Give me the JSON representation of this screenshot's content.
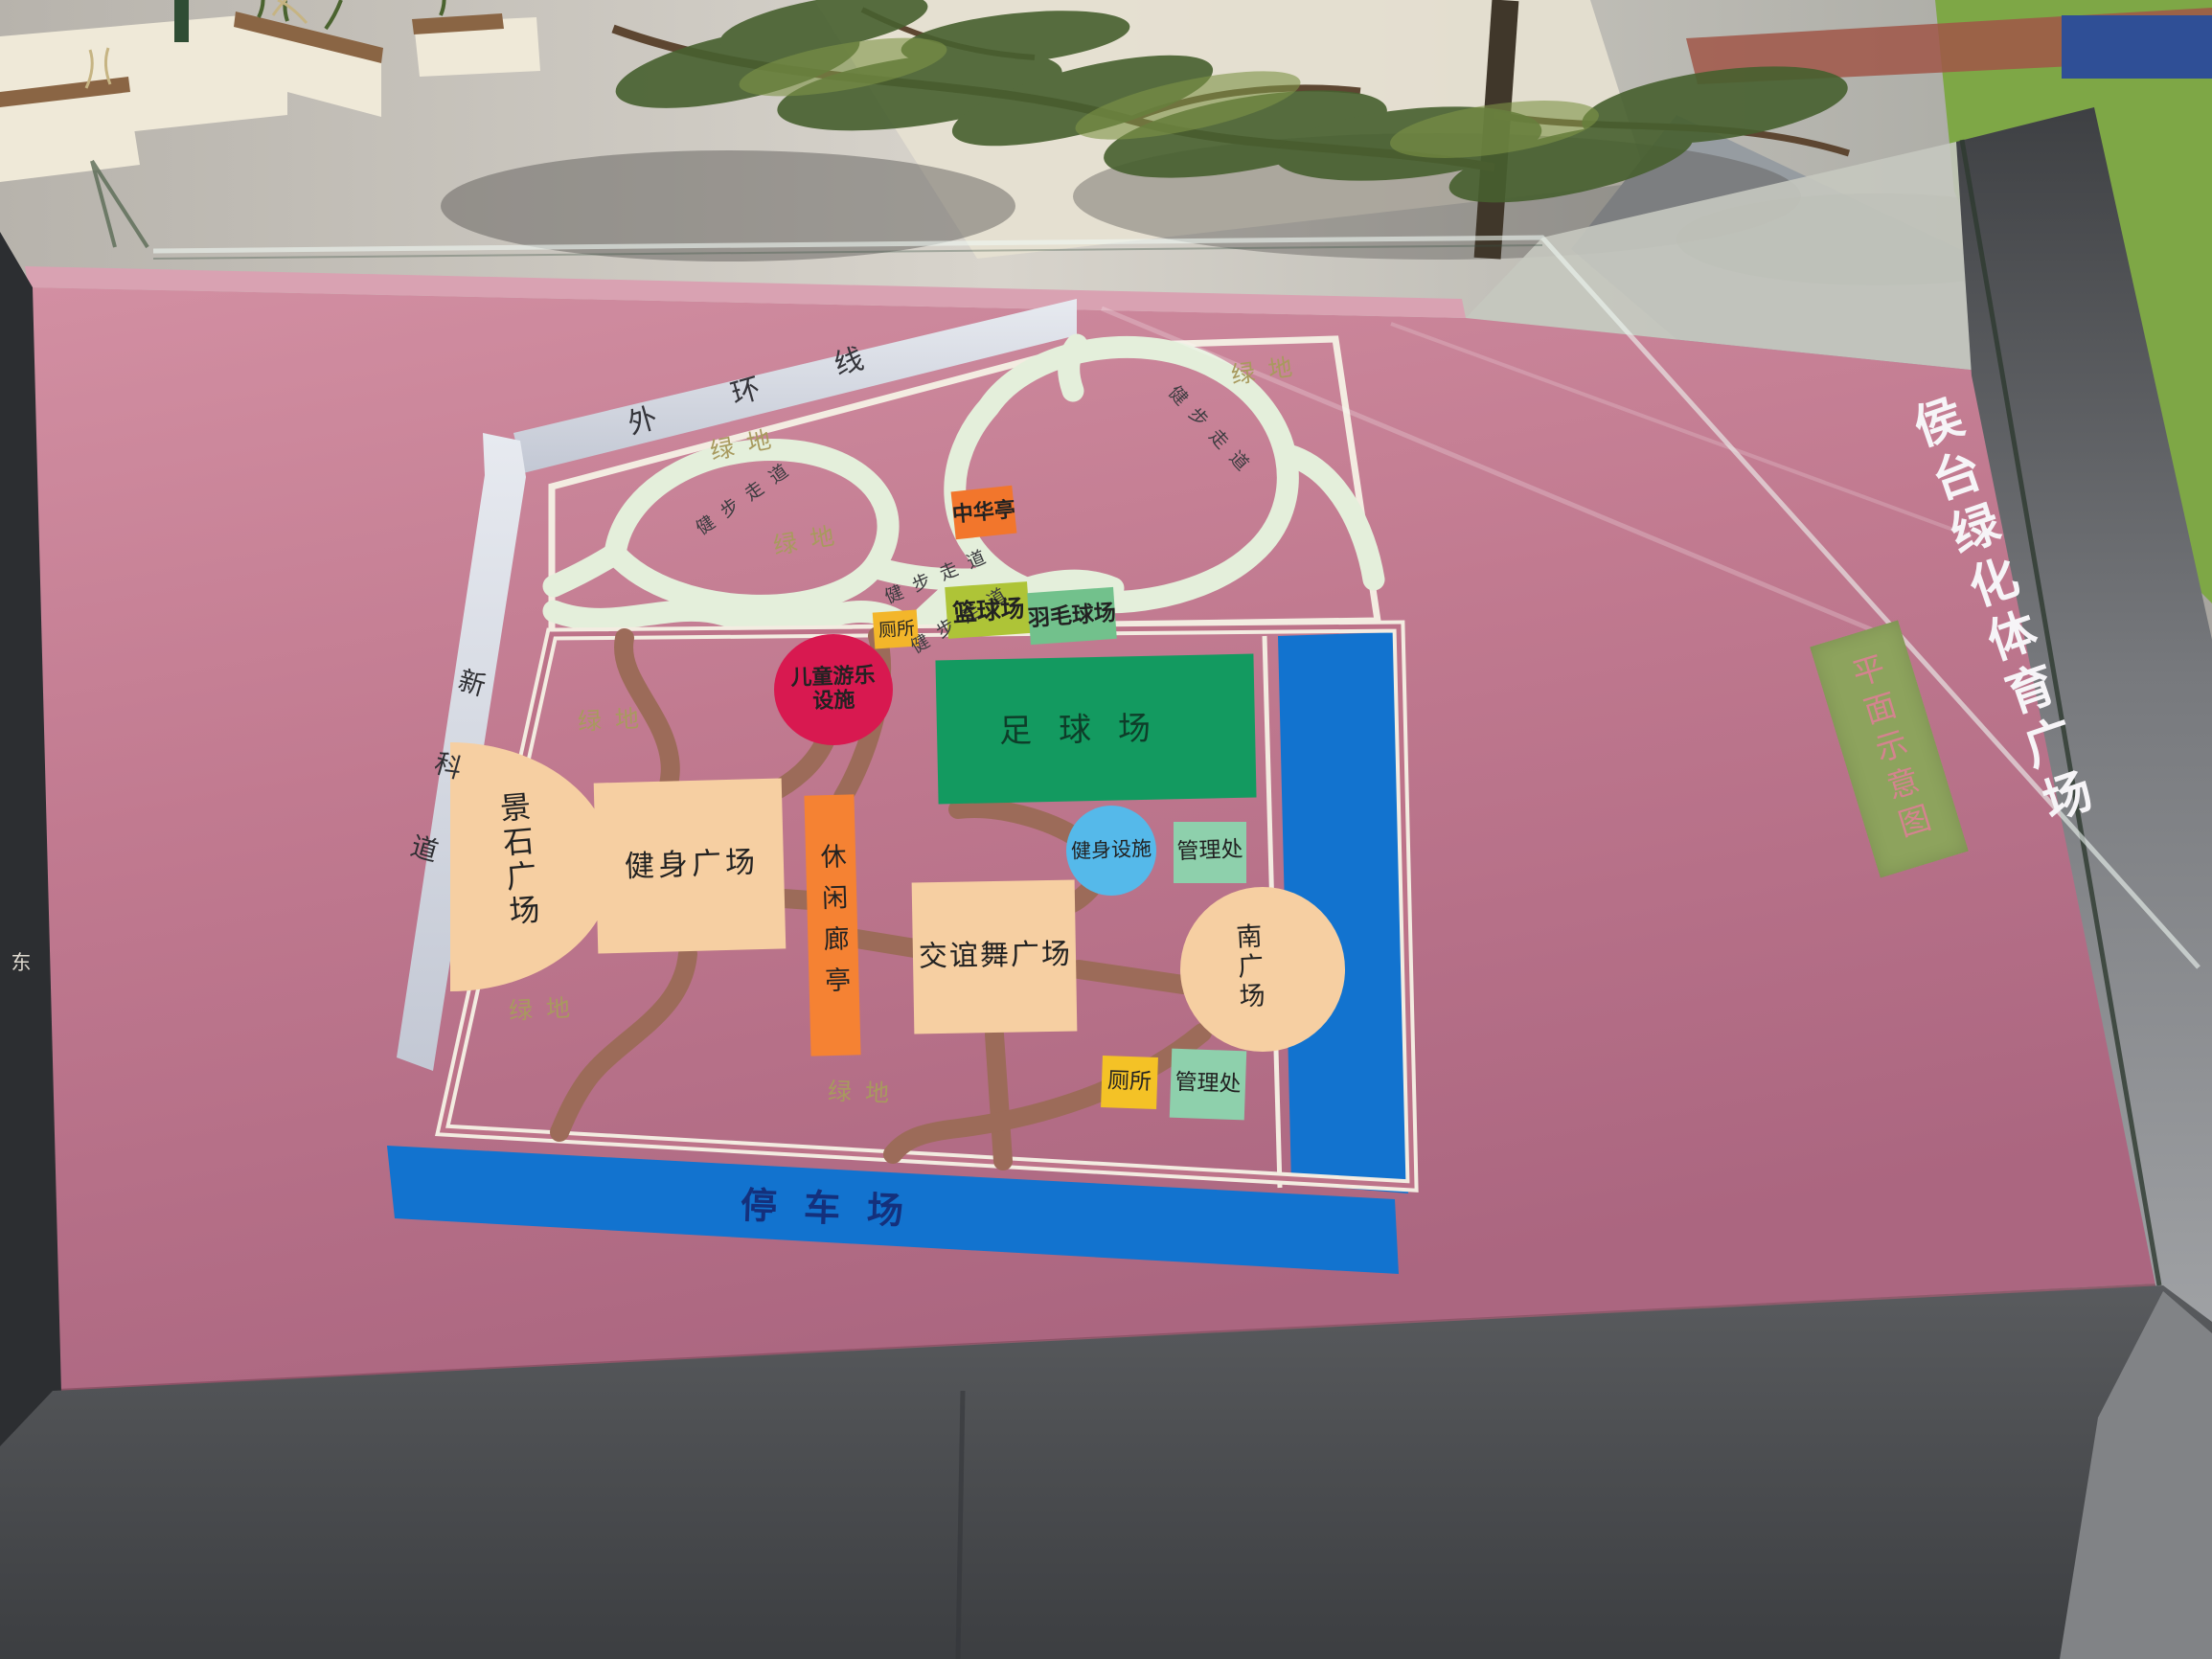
{
  "sign": {
    "title": "侯台绿化体育广场",
    "subtitle": "平面示意图"
  },
  "compass": {
    "direction_label": "东"
  },
  "map": {
    "roads": {
      "outer_ring": "外环线",
      "xinke_road": "新科道"
    },
    "area_labels": {
      "green_space": "绿地",
      "walking_path": "健步走道",
      "parking_lot": "停车场"
    },
    "facilities": {
      "zhonghua_pavilion": "中华亭",
      "toilet": "厕所",
      "basketball_court": "篮球场",
      "badminton_court": "羽毛球场",
      "kids_play": {
        "line1": "儿童游乐",
        "line2": "设施"
      },
      "football_field": "足球场",
      "stone_plaza": "景石广场",
      "fitness_plaza": "健身广场",
      "leisure_corridor": "休闲廊亭",
      "fitness_equipment": "健身设施",
      "management_office": "管理处",
      "dance_plaza": "交谊舞广场",
      "south_plaza": "南广场"
    },
    "colors": {
      "board_pink": "#c27d92",
      "path_mint": "#e4efdb",
      "road_gray": "#d4d8e1",
      "trail_brown": "#9c6b59",
      "strip_blue": "#1273cf",
      "plaza_peach": "#f6cfa2",
      "pitch_green": "#139a60",
      "basketball_green": "#aec437",
      "badminton_green": "#72c18c",
      "management_green": "#8ed0ac",
      "toilet_yellow": "#f3bb2a",
      "pavilion_orange": "#f2762c",
      "kids_red": "#d81950",
      "equipment_blue": "#55b9ea",
      "banner_green": "#8da35d"
    }
  }
}
